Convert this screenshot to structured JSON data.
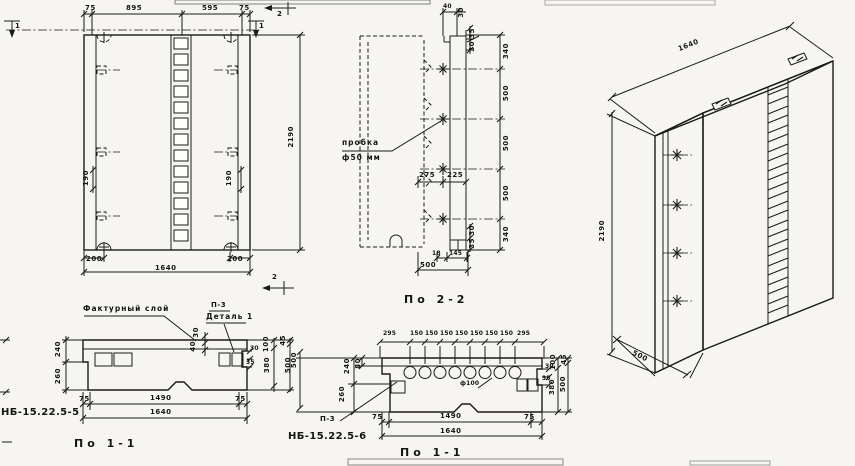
{
  "drawing": {
    "front": {
      "dims_top": [
        "75",
        "895",
        "595",
        "75"
      ],
      "dim_side_left": "190",
      "dim_side_right": "190",
      "dims_bottom": [
        "200",
        "1640",
        "200"
      ],
      "height": "2190",
      "cut_marks": {
        "one_left": "1",
        "one_right": "1",
        "two_top": "2",
        "two_bottom": "2"
      }
    },
    "section_2_2": {
      "title": "По 2-2",
      "plug_label_line1": "пробка",
      "plug_label_line2": "ф50 мм",
      "top_dims": [
        "40",
        "30",
        "35",
        "30"
      ],
      "right_chain": [
        "340",
        "500",
        "500",
        "500",
        "340"
      ],
      "width_dims": [
        "275",
        "225"
      ],
      "bottom_step_dims": [
        "30",
        "35"
      ],
      "bottom_dims": [
        "18",
        "145"
      ],
      "bottom_total": "500"
    },
    "iso": {
      "width": "1640",
      "height": "2190",
      "depth": "500"
    },
    "section_1_1_left": {
      "title": "По 1-1",
      "mark": "НБ-15.22.5-5",
      "facing_layer_label": "Фактурный слой",
      "p3_label": "П-3",
      "detail_label": "Деталь 1",
      "left_chain": [
        "240",
        "260"
      ],
      "layer_dims": [
        "30",
        "40"
      ],
      "step_dims": [
        "30",
        "35"
      ],
      "right_chain": [
        "100",
        "45",
        "380",
        "500"
      ],
      "bottom_dims": [
        "75",
        "1490",
        "75"
      ],
      "bottom_total": "1640"
    },
    "section_1_1_mid": {
      "title": "По 1-1",
      "mark": "НБ-15.22.5-6",
      "p3_label": "П-3",
      "hole_label": "ф100",
      "top_chain": [
        "295",
        "150",
        "150",
        "150",
        "150",
        "150",
        "150",
        "150",
        "295"
      ],
      "left_outer": "500",
      "left_chain": [
        "80",
        "240",
        "260"
      ],
      "step_dims": [
        "30",
        "35"
      ],
      "right_chain": [
        "100",
        "45",
        "380",
        "500"
      ],
      "bottom_dims": [
        "75",
        "1490",
        "75"
      ],
      "bottom_total": "1640"
    }
  }
}
